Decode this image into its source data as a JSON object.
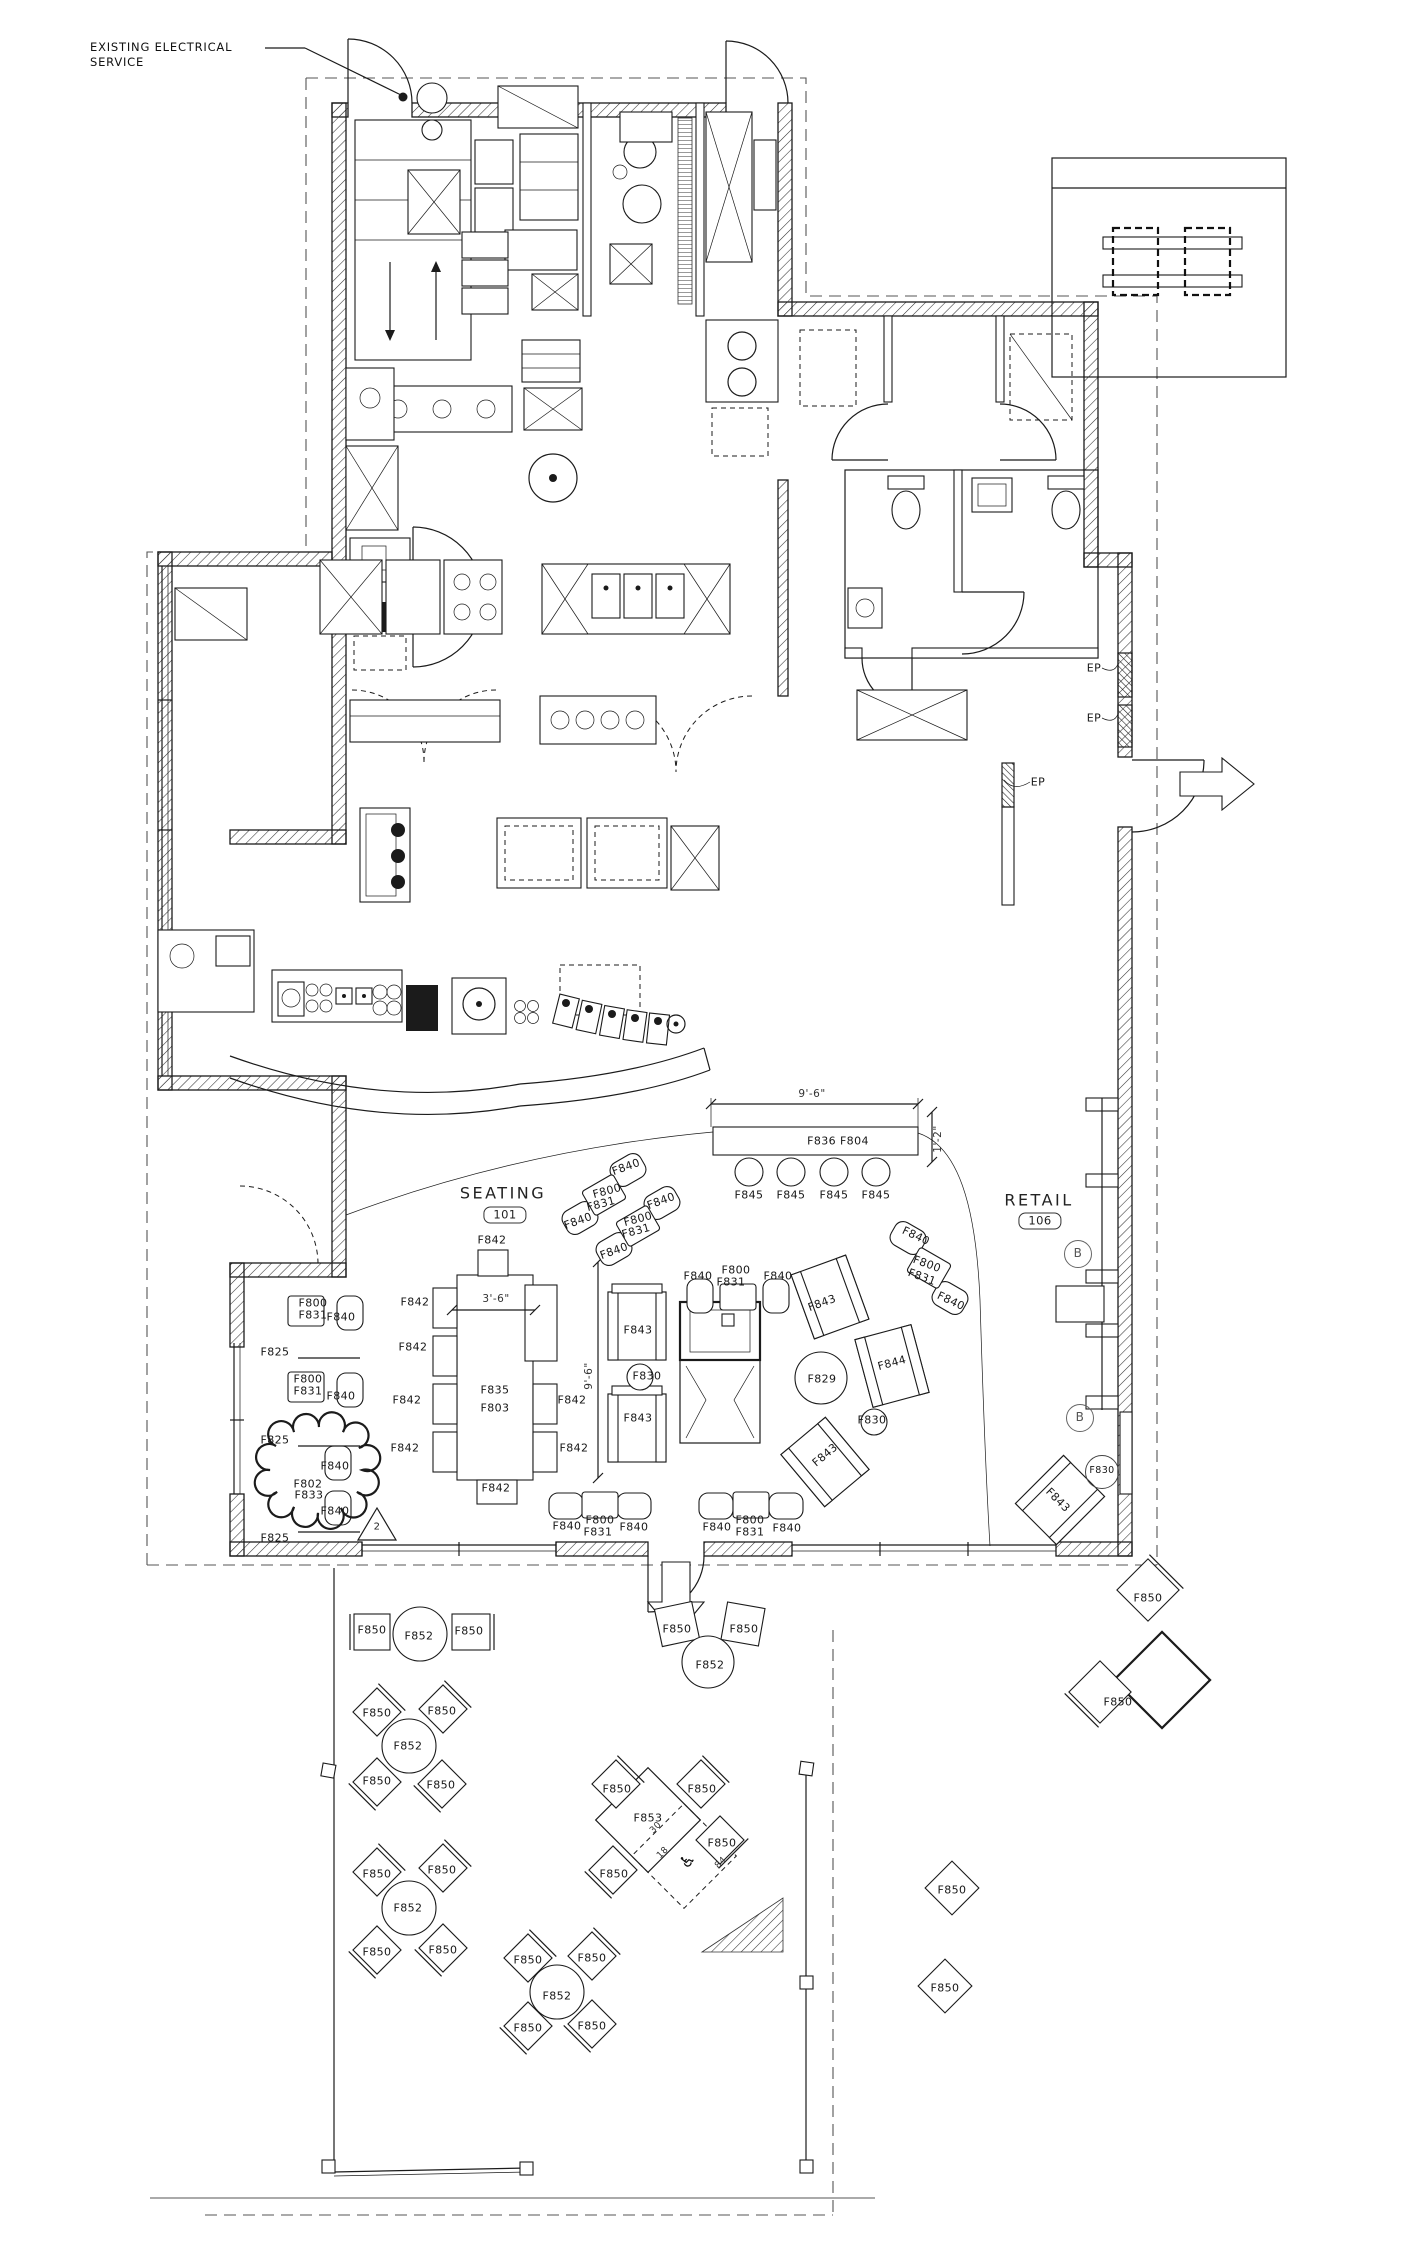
{
  "plan": {
    "title_note": {
      "line1": "EXISTING ELECTRICAL",
      "line2": "SERVICE"
    },
    "rooms": [
      {
        "name": "SEATING",
        "number": "101"
      },
      {
        "name": "RETAIL",
        "number": "106"
      }
    ],
    "colors": {
      "line": "#1b1b1b",
      "dashed": "#555555",
      "paper": "#ffffff"
    },
    "labels": [
      {
        "t": "SEATING",
        "x": 503,
        "y": 1193,
        "c": "room"
      },
      {
        "t": "101",
        "x": 505,
        "y": 1215,
        "c": "numbox"
      },
      {
        "t": "RETAIL",
        "x": 1039,
        "y": 1200,
        "c": "room"
      },
      {
        "t": "106",
        "x": 1040,
        "y": 1221,
        "c": "numbox"
      },
      {
        "t": "EP",
        "x": 1094,
        "y": 668,
        "c": "ep"
      },
      {
        "t": "EP",
        "x": 1094,
        "y": 718,
        "c": "ep"
      },
      {
        "t": "EP",
        "x": 1038,
        "y": 782,
        "c": "ep"
      },
      {
        "t": "B",
        "x": 1078,
        "y": 1254,
        "c": "marker"
      },
      {
        "t": "B",
        "x": 1080,
        "y": 1418,
        "c": "marker"
      },
      {
        "t": "2",
        "x": 377,
        "y": 1527,
        "c": "tri"
      },
      {
        "t": "9'-6\"",
        "x": 812,
        "y": 1094,
        "c": "dim"
      },
      {
        "t": "1'-2\"",
        "x": 938,
        "y": 1139,
        "c": "dim",
        "r": -90
      },
      {
        "t": "3'-6\"",
        "x": 496,
        "y": 1299,
        "c": "dim"
      },
      {
        "t": "9'-6\"",
        "x": 589,
        "y": 1376,
        "c": "dim",
        "r": -90
      },
      {
        "t": "F836 F804",
        "x": 838,
        "y": 1141
      },
      {
        "t": "F845",
        "x": 749,
        "y": 1195
      },
      {
        "t": "F845",
        "x": 791,
        "y": 1195
      },
      {
        "t": "F845",
        "x": 834,
        "y": 1195
      },
      {
        "t": "F845",
        "x": 876,
        "y": 1195
      },
      {
        "t": "F842",
        "x": 415,
        "y": 1302
      },
      {
        "t": "F842",
        "x": 413,
        "y": 1347
      },
      {
        "t": "F842",
        "x": 407,
        "y": 1400
      },
      {
        "t": "F842",
        "x": 405,
        "y": 1448
      },
      {
        "t": "F842",
        "x": 572,
        "y": 1400
      },
      {
        "t": "F842",
        "x": 574,
        "y": 1448
      },
      {
        "t": "F842",
        "x": 492,
        "y": 1240
      },
      {
        "t": "F842",
        "x": 496,
        "y": 1488
      },
      {
        "t": "F835",
        "x": 495,
        "y": 1390
      },
      {
        "t": "F803",
        "x": 495,
        "y": 1408
      },
      {
        "t": "F843",
        "x": 638,
        "y": 1330
      },
      {
        "t": "F843",
        "x": 638,
        "y": 1418
      },
      {
        "t": "F843",
        "x": 822,
        "y": 1303,
        "r": -20
      },
      {
        "t": "F843",
        "x": 825,
        "y": 1455,
        "r": -40
      },
      {
        "t": "F843",
        "x": 1058,
        "y": 1500,
        "r": 45
      },
      {
        "t": "F830",
        "x": 647,
        "y": 1376
      },
      {
        "t": "F830",
        "x": 872,
        "y": 1420
      },
      {
        "t": "F830",
        "x": 1102,
        "y": 1472,
        "c": "codecirc"
      },
      {
        "t": "F829",
        "x": 822,
        "y": 1379
      },
      {
        "t": "F844",
        "x": 892,
        "y": 1363,
        "r": -15
      },
      {
        "t": "F840",
        "x": 626,
        "y": 1167,
        "r": -20
      },
      {
        "t": "F800",
        "x": 607,
        "y": 1191,
        "r": -15
      },
      {
        "t": "F831",
        "x": 601,
        "y": 1204,
        "r": -15
      },
      {
        "t": "F840",
        "x": 578,
        "y": 1221,
        "r": -20
      },
      {
        "t": "F840",
        "x": 661,
        "y": 1201,
        "r": -20
      },
      {
        "t": "F800",
        "x": 638,
        "y": 1219,
        "r": -15
      },
      {
        "t": "F831",
        "x": 636,
        "y": 1231,
        "r": -15
      },
      {
        "t": "F840",
        "x": 614,
        "y": 1251,
        "r": -20
      },
      {
        "t": "F840",
        "x": 916,
        "y": 1236,
        "r": 25
      },
      {
        "t": "F800",
        "x": 927,
        "y": 1264,
        "r": 20
      },
      {
        "t": "F831",
        "x": 922,
        "y": 1277,
        "r": 20
      },
      {
        "t": "F840",
        "x": 951,
        "y": 1301,
        "r": 25
      },
      {
        "t": "F840",
        "x": 698,
        "y": 1276
      },
      {
        "t": "F800",
        "x": 736,
        "y": 1270
      },
      {
        "t": "F831",
        "x": 731,
        "y": 1282
      },
      {
        "t": "F840",
        "x": 778,
        "y": 1276
      },
      {
        "t": "F800",
        "x": 313,
        "y": 1303
      },
      {
        "t": "F831",
        "x": 313,
        "y": 1315
      },
      {
        "t": "F840",
        "x": 341,
        "y": 1317
      },
      {
        "t": "F800",
        "x": 308,
        "y": 1379
      },
      {
        "t": "F831",
        "x": 308,
        "y": 1391
      },
      {
        "t": "F840",
        "x": 341,
        "y": 1396
      },
      {
        "t": "F840",
        "x": 567,
        "y": 1526
      },
      {
        "t": "F800",
        "x": 600,
        "y": 1520
      },
      {
        "t": "F831",
        "x": 598,
        "y": 1532
      },
      {
        "t": "F840",
        "x": 634,
        "y": 1527
      },
      {
        "t": "F840",
        "x": 717,
        "y": 1527
      },
      {
        "t": "F800",
        "x": 750,
        "y": 1520
      },
      {
        "t": "F831",
        "x": 750,
        "y": 1532
      },
      {
        "t": "F840",
        "x": 787,
        "y": 1528
      },
      {
        "t": "F840",
        "x": 335,
        "y": 1466
      },
      {
        "t": "F802",
        "x": 308,
        "y": 1484
      },
      {
        "t": "F833",
        "x": 309,
        "y": 1495
      },
      {
        "t": "F840",
        "x": 335,
        "y": 1511
      },
      {
        "t": "F825",
        "x": 275,
        "y": 1352
      },
      {
        "t": "F825",
        "x": 275,
        "y": 1440
      },
      {
        "t": "F825",
        "x": 275,
        "y": 1538
      },
      {
        "t": "F850",
        "x": 372,
        "y": 1630
      },
      {
        "t": "F852",
        "x": 419,
        "y": 1636
      },
      {
        "t": "F850",
        "x": 469,
        "y": 1631
      },
      {
        "t": "F850",
        "x": 677,
        "y": 1629
      },
      {
        "t": "F850",
        "x": 744,
        "y": 1629
      },
      {
        "t": "F852",
        "x": 710,
        "y": 1665
      },
      {
        "t": "F850",
        "x": 377,
        "y": 1713
      },
      {
        "t": "F850",
        "x": 442,
        "y": 1711
      },
      {
        "t": "F852",
        "x": 408,
        "y": 1746
      },
      {
        "t": "F850",
        "x": 377,
        "y": 1781
      },
      {
        "t": "F850",
        "x": 441,
        "y": 1785
      },
      {
        "t": "F850",
        "x": 377,
        "y": 1874
      },
      {
        "t": "F850",
        "x": 442,
        "y": 1870
      },
      {
        "t": "F852",
        "x": 408,
        "y": 1908
      },
      {
        "t": "F850",
        "x": 377,
        "y": 1952
      },
      {
        "t": "F850",
        "x": 443,
        "y": 1950
      },
      {
        "t": "F850",
        "x": 528,
        "y": 1960
      },
      {
        "t": "F850",
        "x": 592,
        "y": 1958
      },
      {
        "t": "F852",
        "x": 557,
        "y": 1996
      },
      {
        "t": "F850",
        "x": 528,
        "y": 2028
      },
      {
        "t": "F850",
        "x": 592,
        "y": 2026
      },
      {
        "t": "F853",
        "x": 648,
        "y": 1818
      },
      {
        "t": "F850",
        "x": 617,
        "y": 1789
      },
      {
        "t": "F850",
        "x": 702,
        "y": 1789
      },
      {
        "t": "F850",
        "x": 614,
        "y": 1874
      },
      {
        "t": "F850",
        "x": 722,
        "y": 1843
      },
      {
        "t": "30",
        "x": 656,
        "y": 1828,
        "c": "dims",
        "r": -45
      },
      {
        "t": "18",
        "x": 663,
        "y": 1853,
        "c": "dims",
        "r": -45
      },
      {
        "t": "84",
        "x": 721,
        "y": 1863,
        "c": "dims",
        "r": -45
      },
      {
        "t": "♿",
        "x": 688,
        "y": 1861,
        "c": "access",
        "r": -45
      },
      {
        "t": "F850",
        "x": 952,
        "y": 1890
      },
      {
        "t": "F850",
        "x": 945,
        "y": 1988
      },
      {
        "t": "F850",
        "x": 1148,
        "y": 1598
      },
      {
        "t": "F850",
        "x": 1118,
        "y": 1702
      }
    ]
  }
}
